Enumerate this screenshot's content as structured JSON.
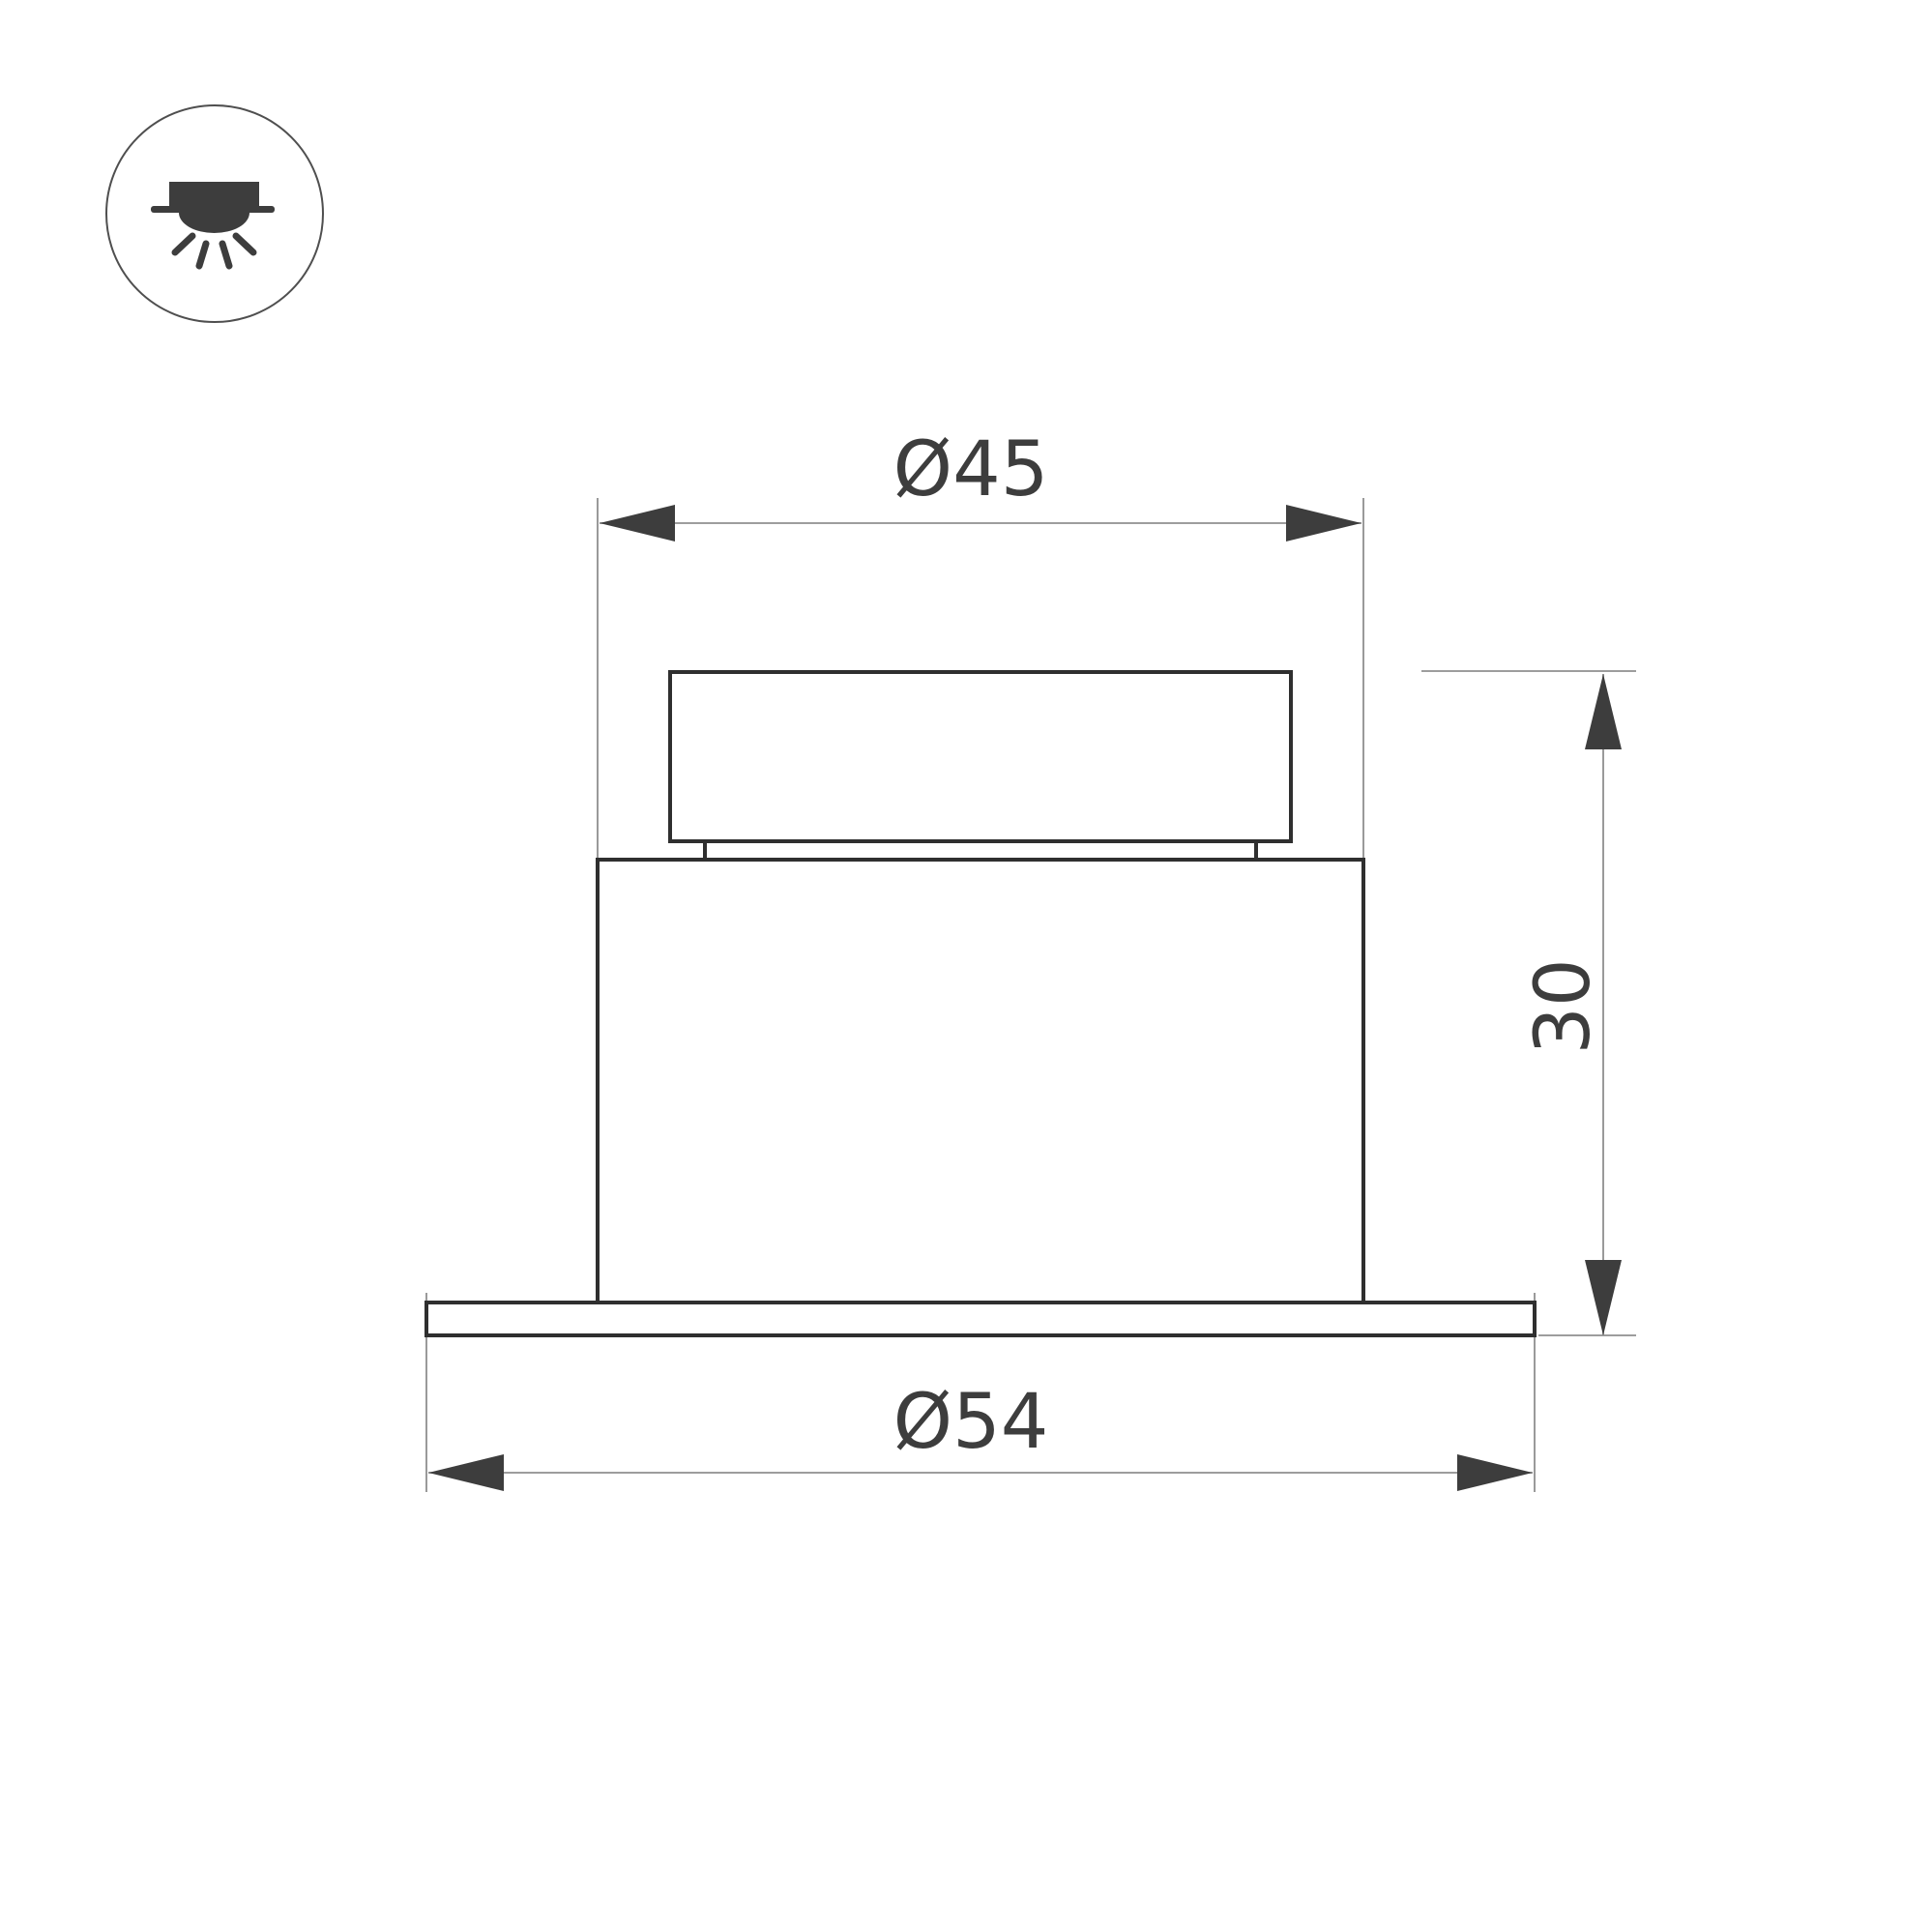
{
  "page": {
    "background": "#ffffff",
    "title": "recessed-downlight-technical-drawing"
  },
  "icon": {
    "name": "recessed-downlight-mounting-icon",
    "glyph_color": "#3d3d3d",
    "circle_color": "#4f4f4f"
  },
  "drawing": {
    "view": "front",
    "outline_color": "#2f2f2f",
    "dimension_line_color": "#8f8f8f",
    "arrow_color": "#3d3d3d",
    "text_color": "#3d3d3d",
    "dimensions": {
      "top_diameter": {
        "label": "Ø45",
        "value": 45
      },
      "bottom_diameter": {
        "label": "Ø54",
        "value": 54
      },
      "height": {
        "label": "30",
        "value": 30
      }
    }
  }
}
